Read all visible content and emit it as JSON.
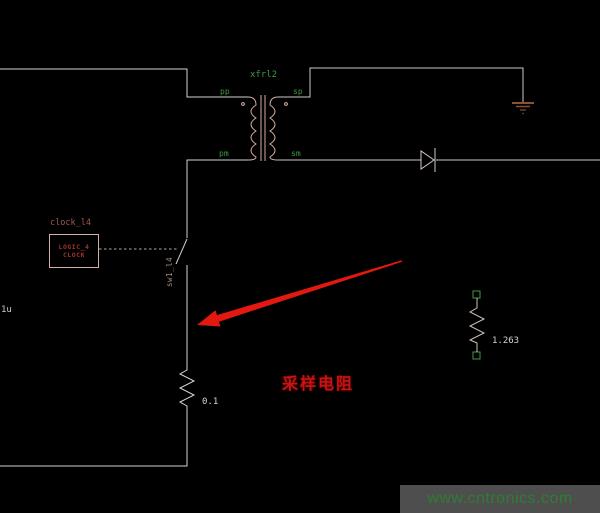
{
  "canvas": {
    "background": "#000000"
  },
  "schematic": {
    "transformer": {
      "name": "xfrl2",
      "pin_pp": "pp",
      "pin_sp": "sp",
      "pin_pm": "pm",
      "pin_sm": "sm"
    },
    "clock_source": {
      "ref_label": "clock_l4",
      "box_line1": "LOGIC_4",
      "box_line2": "CLOCK"
    },
    "switch": {
      "ref_label": "sw1_l4"
    },
    "sense_resistor": {
      "value": "0.1"
    },
    "load_resistor": {
      "value": "1.263"
    },
    "edge_component": {
      "value": "1u"
    }
  },
  "annotations": {
    "sampling_resistor_label": "采样电阻",
    "label_color": "#c41414",
    "arrow_color": "#e3190f"
  },
  "watermark": {
    "text": "www.cntronics.com",
    "text_color": "#2e7d32",
    "background": "#4e4e4e"
  },
  "colors": {
    "wire": "#d2d2d4",
    "component_outline": "#d4b0a0",
    "net_label_green": "#3f9b3f",
    "clock_text": "#9e332c",
    "value_text": "#d9d4cd",
    "ground": "#8a5130",
    "terminal_square_green": "#3f9b3f"
  }
}
